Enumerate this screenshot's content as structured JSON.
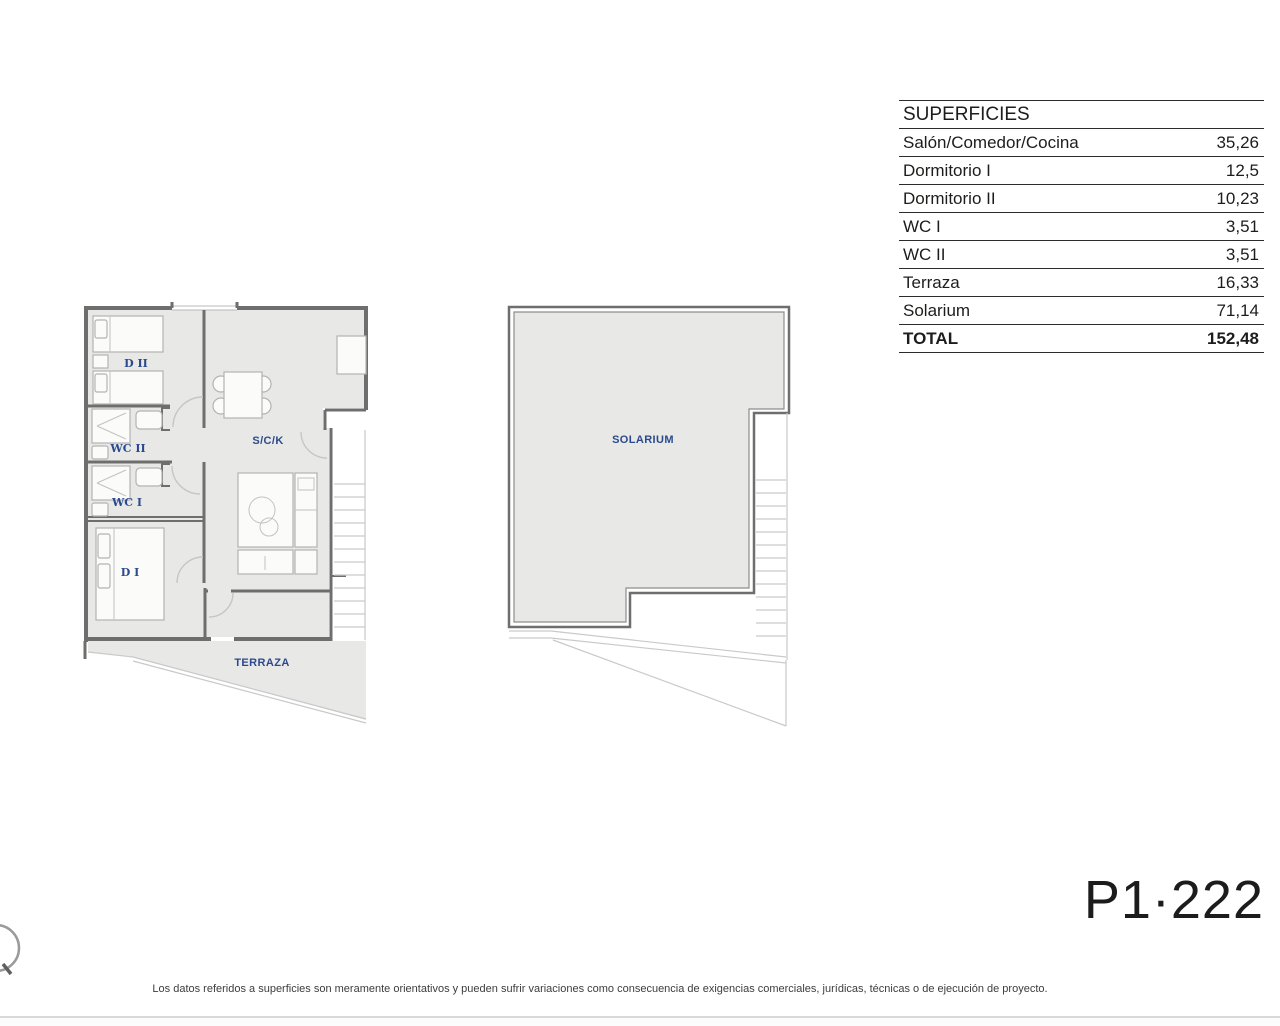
{
  "surfaces_table": {
    "title": "SUPERFICIES",
    "rows": [
      {
        "label": "Salón/Comedor/Cocina",
        "value": "35,26"
      },
      {
        "label": "Dormitorio I",
        "value": "12,5"
      },
      {
        "label": "Dormitorio II",
        "value": "10,23"
      },
      {
        "label": "WC I",
        "value": "3,51"
      },
      {
        "label": "WC II",
        "value": "3,51"
      },
      {
        "label": "Terraza",
        "value": "16,33"
      },
      {
        "label": "Solarium",
        "value": "71,14"
      },
      {
        "label": "TOTAL",
        "value": "152,48"
      }
    ]
  },
  "floor_plan": {
    "labels": {
      "dormitorio2": "D II",
      "wc2": "WC II",
      "wc1": "WC I",
      "dormitorio1": "D I",
      "sck": "S/C/K",
      "terraza": "TERRAZA"
    }
  },
  "solarium_plan": {
    "label": "SOLARIUM"
  },
  "plan_code": "P1·222",
  "footer_disclaimer": "Los datos referidos a superficies son meramente orientativos y pueden sufrir variaciones como consecuencia de exigencias comerciales, jurídicas, técnicas o de ejecución de proyecto.",
  "colors": {
    "floor_fill": "#e8e8e7",
    "wall": "#6e6e6e",
    "label_blue": "#2b4a8d",
    "text_black": "#1d1d1b"
  }
}
